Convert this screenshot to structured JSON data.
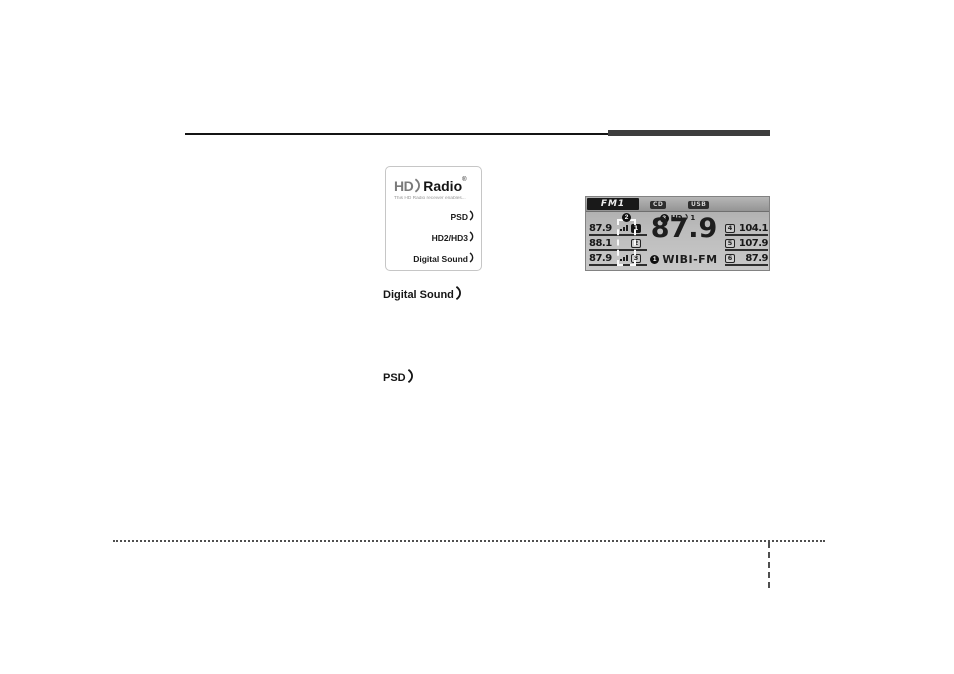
{
  "hd_logo_box": {
    "brand_hd": "HD",
    "brand_radio": "Radio",
    "registered_mark": "®",
    "tagline": "This HD Radio receiver enables...",
    "features": [
      "PSD",
      "HD2/HD3",
      "Digital Sound"
    ]
  },
  "standalone_badges": {
    "digital_sound": "Digital Sound",
    "psd": "PSD"
  },
  "radio_display": {
    "band": "FM1",
    "source_cd": "CD",
    "source_usb": "USB",
    "hd_status": {
      "callout_num": "3",
      "hd_label": "HD",
      "channel": "1"
    },
    "hd_icon_callout": "2",
    "current": {
      "frequency": "87.9",
      "station_callout": "1",
      "station_name": "WIBI-FM"
    },
    "presets_left": [
      {
        "frequency": "87.9",
        "preset_num": "1",
        "hd_multicast": true,
        "selected": true
      },
      {
        "frequency": "88.1",
        "preset_num": "2",
        "hd_multicast": false,
        "selected": false
      },
      {
        "frequency": "87.9",
        "preset_num": "3",
        "hd_multicast": true,
        "selected": false
      }
    ],
    "presets_right": [
      {
        "preset_num": "4",
        "frequency": "104.1"
      },
      {
        "preset_num": "5",
        "frequency": "107.9"
      },
      {
        "preset_num": "6",
        "frequency": "87.9"
      }
    ]
  },
  "colors": {
    "display_bg_top": "#a9a9a9",
    "display_bg_bottom": "#c8c8c8",
    "display_dark": "#191919",
    "rule_dark": "#3d3d3d"
  }
}
